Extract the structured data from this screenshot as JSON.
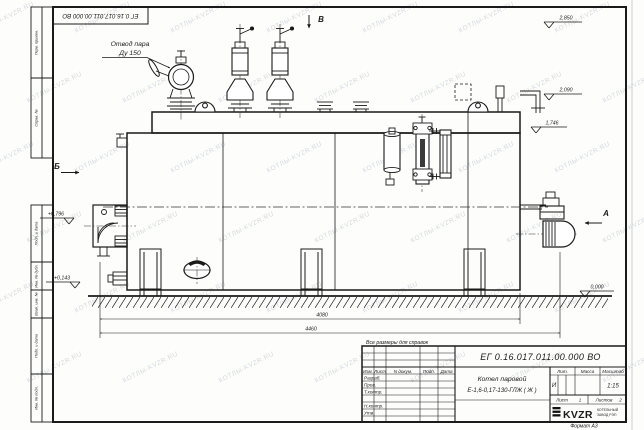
{
  "sheet": {
    "top_stamp": "ЕГ 0.16.017.011.00.000  ВО",
    "format_label": "Формат А3",
    "reference_note": "Все размеры для справок",
    "margin_boxes": [
      "Перв. примен.",
      "Справ. №",
      "Подп. и дата",
      "Инв. № дубл.",
      "Взам. инв. №",
      "Подп. и дата",
      "Инв. № подл."
    ]
  },
  "watermark": {
    "text": "КОТЛЫ-KVZR.RU"
  },
  "drawing": {
    "callouts": {
      "steam_outlet_line1": "Отвод пара",
      "steam_outlet_line2": "Ду 150"
    },
    "view_labels": {
      "a": "А",
      "b": "Б",
      "v": "В"
    },
    "elevations": {
      "e2850": "2,850",
      "e2090": "2,090",
      "e1746": "1,746",
      "e0796": "+0,796",
      "e0143": "+0,143",
      "e0000": "0,000"
    },
    "dimensions": {
      "d4080": "4080",
      "d4460": "4460"
    }
  },
  "title_block": {
    "doc_number": "ЕГ 0.16.017.011.00.000  ВО",
    "name_line1": "Котел паровой",
    "name_line2": "Е-1,6-0,17-130-ГЛЖ ( Ж )",
    "headers": {
      "izm": "Изм.",
      "list": "Лист",
      "doc": "N докум.",
      "sign": "Подп.",
      "date": "Дата",
      "lit": "Лит.",
      "mass": "Масса",
      "scale": "Масштаб",
      "sheet": "Лист",
      "sheets": "Листов"
    },
    "rows": {
      "razrab": "Разраб.",
      "prov": "Пров.",
      "tkontr": "Т.контр.",
      "nkontr": "Н.контр.",
      "utv": "Утв."
    },
    "values": {
      "lit": "И",
      "scale": "1:15",
      "sheet_no": "1",
      "sheets_total": "2"
    },
    "logo": {
      "text": "KVZR",
      "sub1": "КОТЕЛЬНЫЙ",
      "sub2": "ЗАВОД РЭП"
    }
  }
}
